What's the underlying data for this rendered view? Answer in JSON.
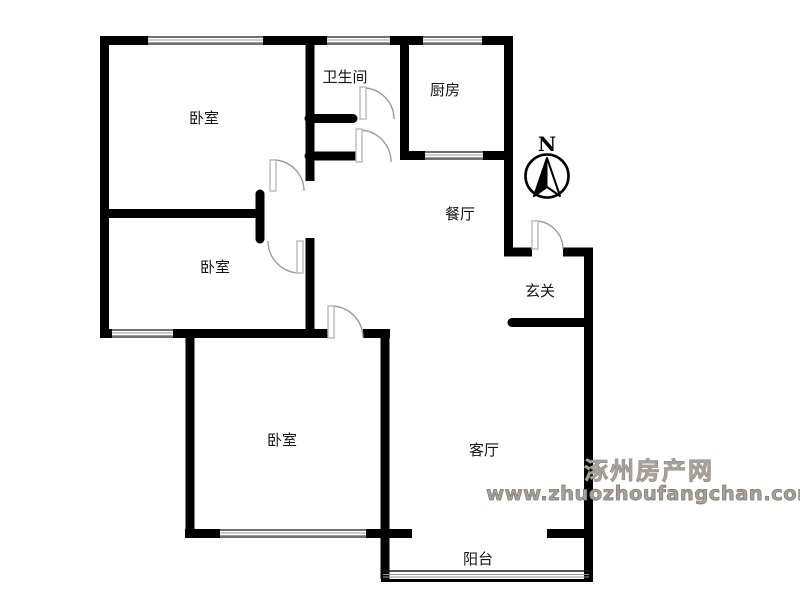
{
  "rooms": [
    {
      "id": "bedroom-1",
      "label": "卧室"
    },
    {
      "id": "bathroom",
      "label": "卫生间"
    },
    {
      "id": "kitchen",
      "label": "厨房"
    },
    {
      "id": "dining",
      "label": "餐厅"
    },
    {
      "id": "foyer",
      "label": "玄关"
    },
    {
      "id": "bedroom-2",
      "label": "卧室"
    },
    {
      "id": "bedroom-3",
      "label": "卧室"
    },
    {
      "id": "living",
      "label": "客厅"
    },
    {
      "id": "balcony",
      "label": "阳台"
    }
  ],
  "compass": {
    "north_label": "N"
  },
  "watermark": {
    "line1": "涿州房产网",
    "line2": "www.zhuozhoufangchan.com",
    "color": "#a8a19a"
  },
  "colors": {
    "wall": "#000000",
    "door_arc": "#9c9c9c",
    "door_leaf_edge": "#b9b9b9",
    "background": "#ffffff"
  }
}
